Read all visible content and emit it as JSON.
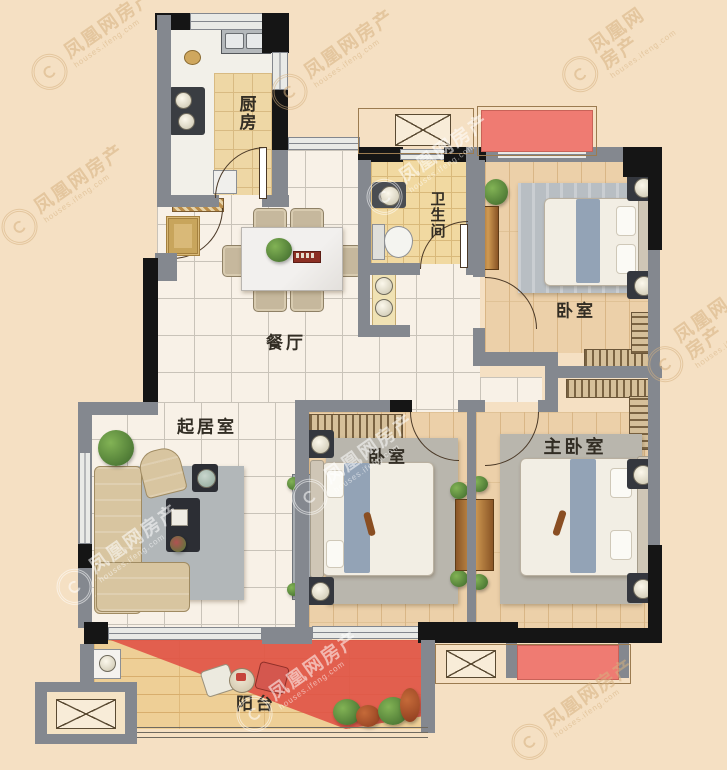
{
  "rooms": {
    "kitchen": {
      "label": "厨房"
    },
    "bathroom": {
      "label": "卫生间"
    },
    "dining": {
      "label": "餐厅"
    },
    "bedroom_north": {
      "label": "卧室"
    },
    "living": {
      "label": "起居室"
    },
    "bedroom_middle": {
      "label": "卧室"
    },
    "master_bedroom": {
      "label": "主卧室"
    },
    "balcony": {
      "label": "阳台"
    }
  },
  "watermark": {
    "brand": "凤凰网房产",
    "domain": "houses.ifeng.com"
  },
  "colors": {
    "background": "#f5e0c3",
    "wall_gray": "#84888f",
    "wall_black": "#151515",
    "flower_bed_red": "#ef7b72",
    "balcony_red": "#e05044",
    "tile_floor": "#f8f1e7",
    "wood_floor": "#ecd0a9",
    "bathroom_tile": "#f1d9a1",
    "kitchen_tile": "#eed7a5"
  }
}
